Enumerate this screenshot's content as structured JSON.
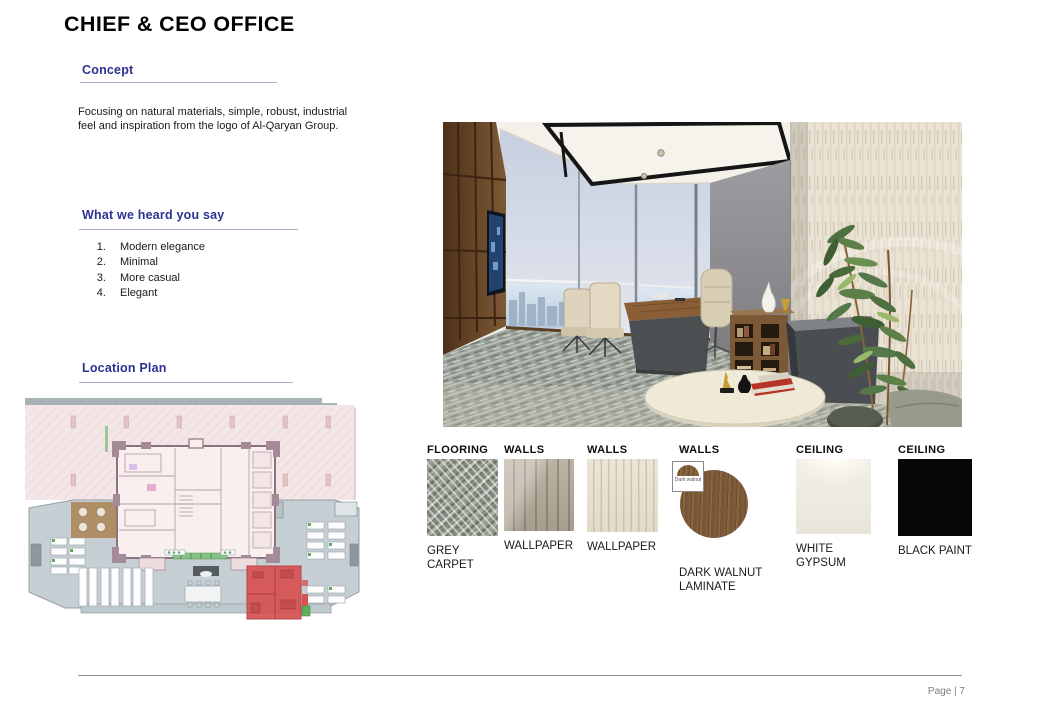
{
  "page": {
    "title": "CHIEF & CEO OFFICE",
    "footer": {
      "label": "Page | 7"
    }
  },
  "sections": {
    "concept": {
      "heading": "Concept",
      "body": "Focusing on natural materials, simple, robust, industrial feel and inspiration from the logo of Al-Qaryan Group."
    },
    "feedback": {
      "heading": "What we heard you say",
      "items": [
        "Modern elegance",
        "Minimal",
        "More casual",
        "Elegant"
      ]
    },
    "location": {
      "heading": "Location Plan"
    }
  },
  "materials": [
    {
      "category": "FLOORING",
      "name": "GREY CARPET"
    },
    {
      "category": "WALLS",
      "name": "WALLPAPER"
    },
    {
      "category": "WALLS",
      "name": "WALLPAPER"
    },
    {
      "category": "WALLS",
      "name": "DARK WALNUT LAMINATE",
      "swatch_label": "Dark walnut"
    },
    {
      "category": "CEILING",
      "name": "WHITE GYPSUM"
    },
    {
      "category": "CEILING",
      "name": "BLACK PAINT"
    }
  ],
  "colors": {
    "heading_blue": "#2E3192",
    "rule_grey": "#A9AFC9",
    "body_text": "#1A1A1A",
    "footer_text": "#7F7F7F",
    "location_highlight_red": "#D85252",
    "swatches": {
      "grey_carpet": "#9AA095",
      "wallpaper_taupe": "#B3A998",
      "wallpaper_cream": "#E8E1D2",
      "dark_walnut": "#74553A",
      "white_gypsum": "#F1EDE6",
      "black_paint": "#070707"
    }
  }
}
